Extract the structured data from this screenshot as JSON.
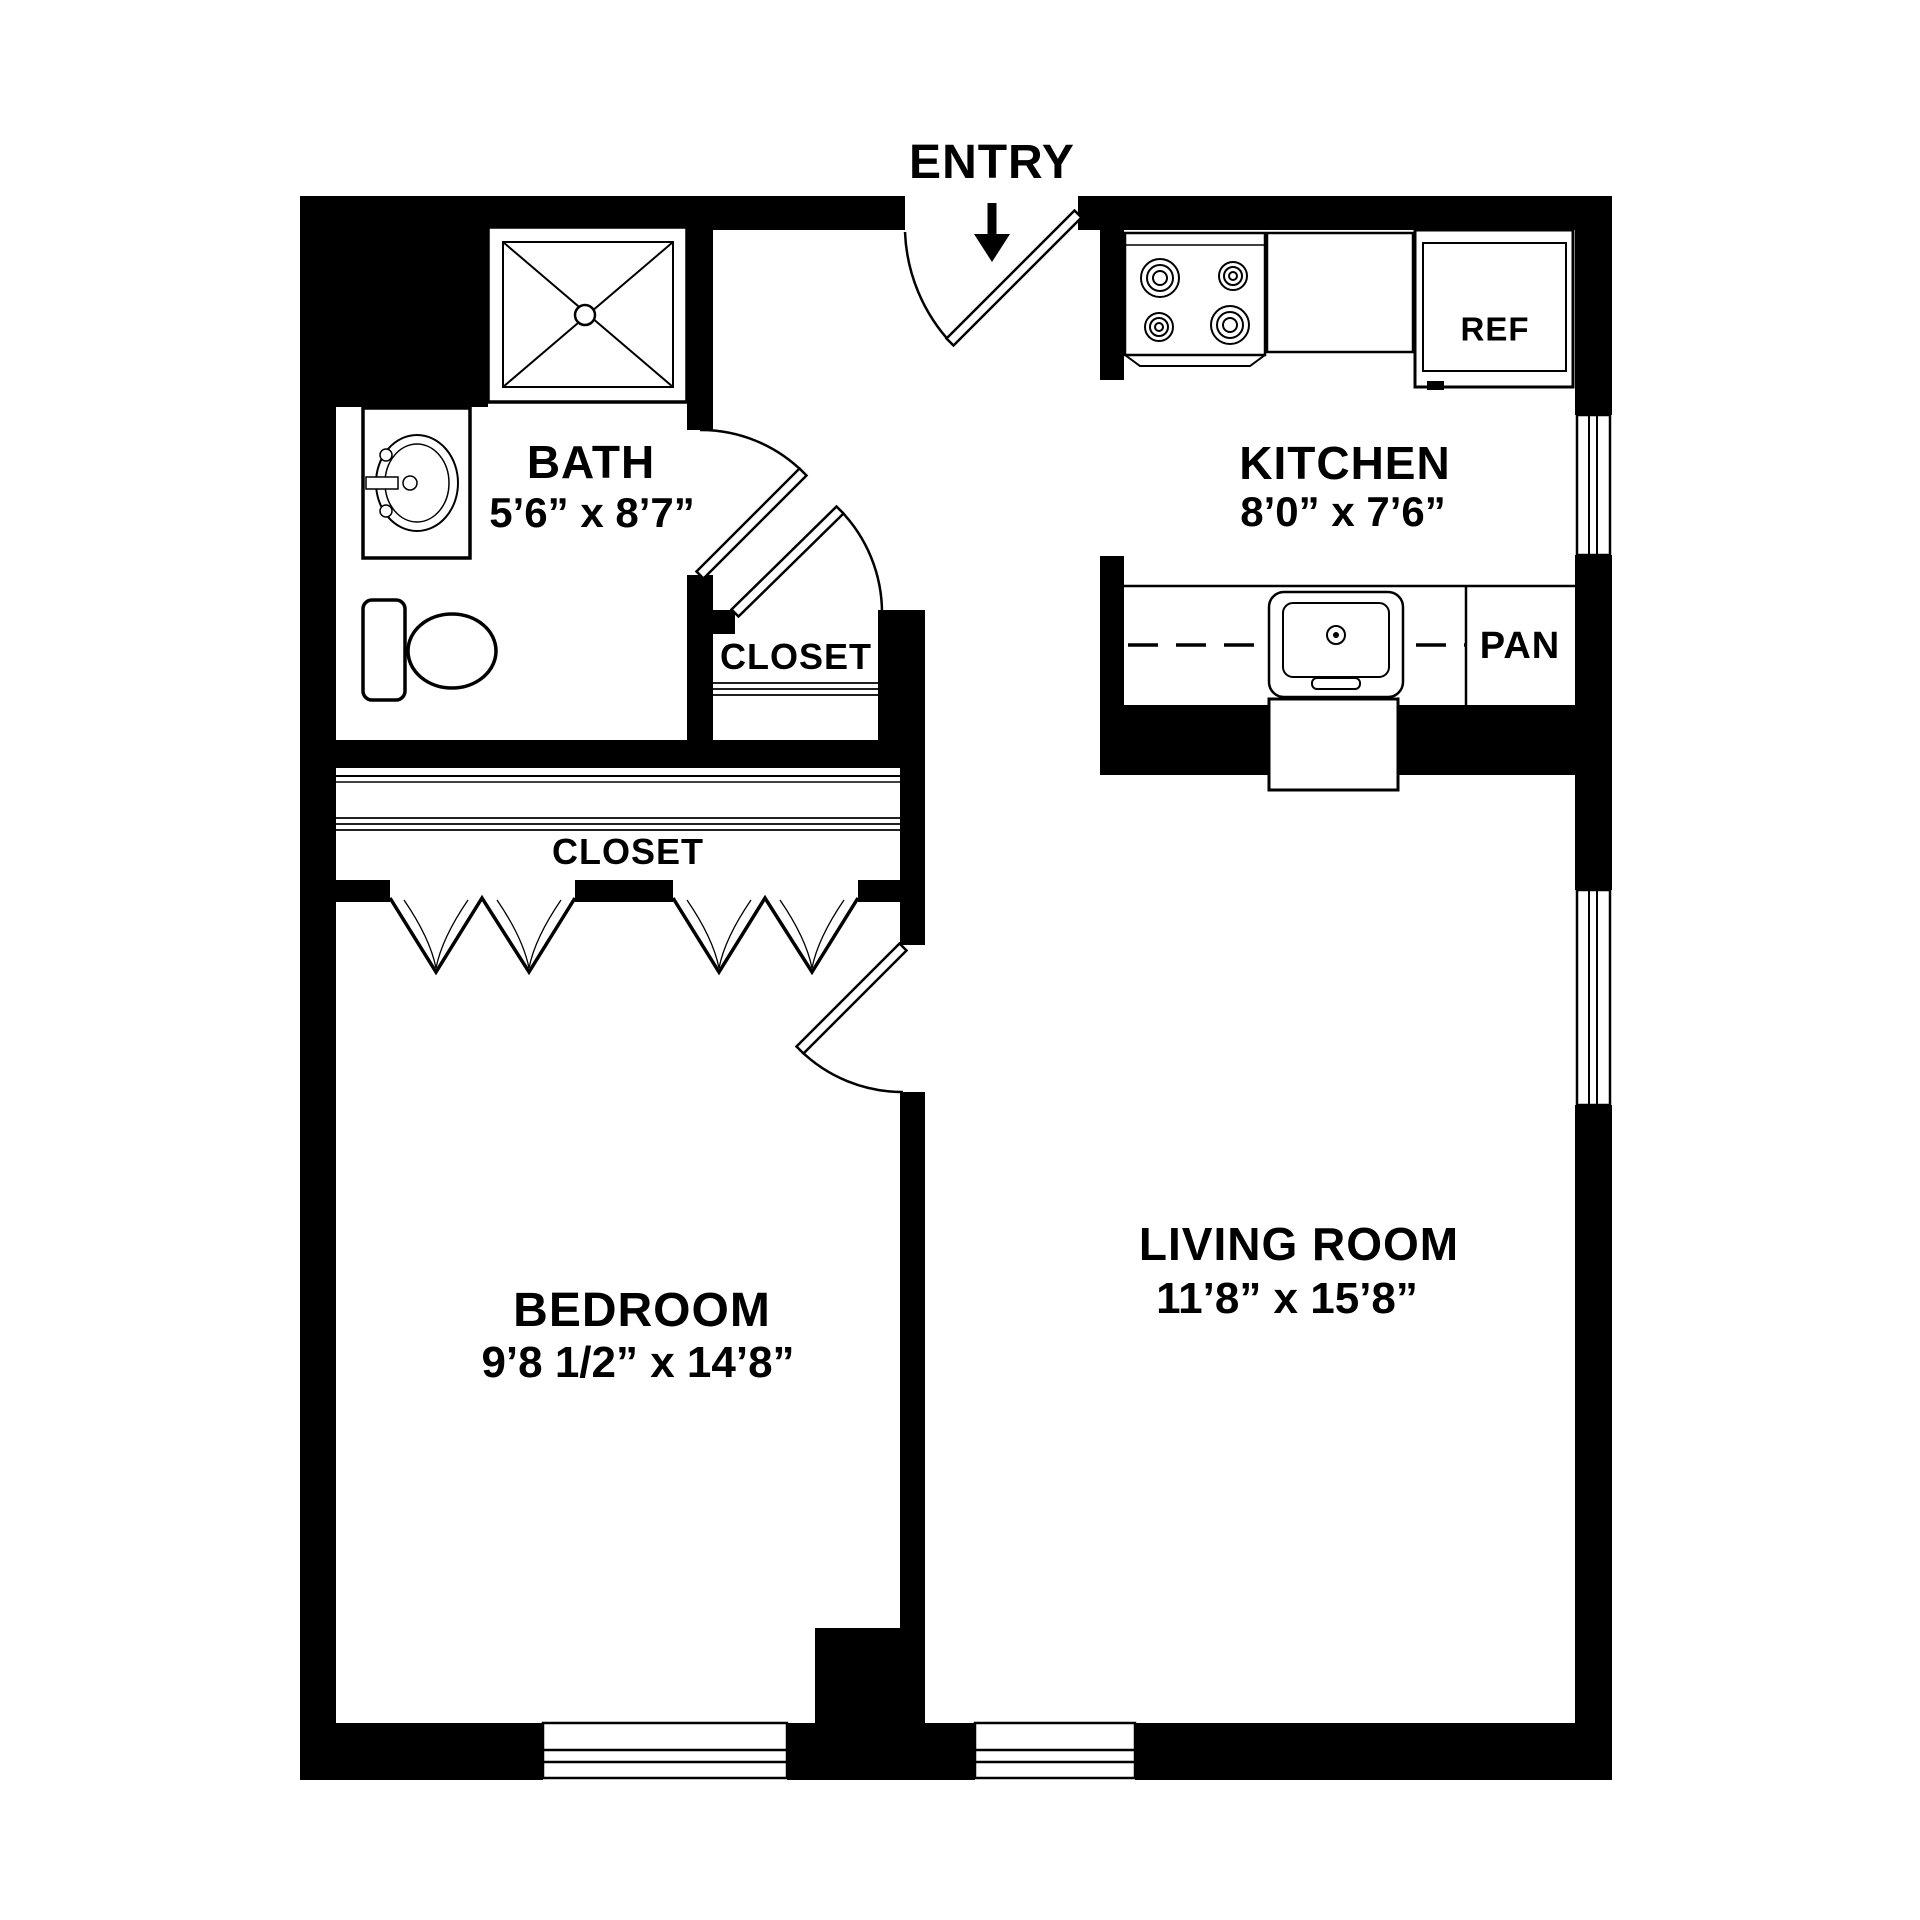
{
  "plan": {
    "title": "one-bedroom apartment floor plan",
    "colors": {
      "wall": "#000000",
      "background": "#ffffff",
      "line": "#000000"
    },
    "entry": {
      "label": "ENTRY"
    },
    "bath": {
      "name": "BATH",
      "dims": "5’6” x 8’7”"
    },
    "hall_closet": {
      "label": "CLOSET"
    },
    "bedroom_closet": {
      "label": "CLOSET"
    },
    "kitchen": {
      "name": "KITCHEN",
      "dims": "8’0” x 7’6”",
      "pantry_label": "PAN",
      "refrigerator_label": "REF"
    },
    "bedroom": {
      "name": "BEDROOM",
      "dims": "9’8 1/2” x 14’8”"
    },
    "living_room": {
      "name": "LIVING ROOM",
      "dims": "11’8” x 15’8”"
    },
    "fixtures": [
      "shower",
      "vanity-sink",
      "toilet",
      "stove",
      "refrigerator",
      "kitchen-sink",
      "dishwasher",
      "pantry",
      "entry-door",
      "bath-door",
      "closet-door",
      "bedroom-door",
      "bifold-closet-doors",
      "windows"
    ]
  }
}
